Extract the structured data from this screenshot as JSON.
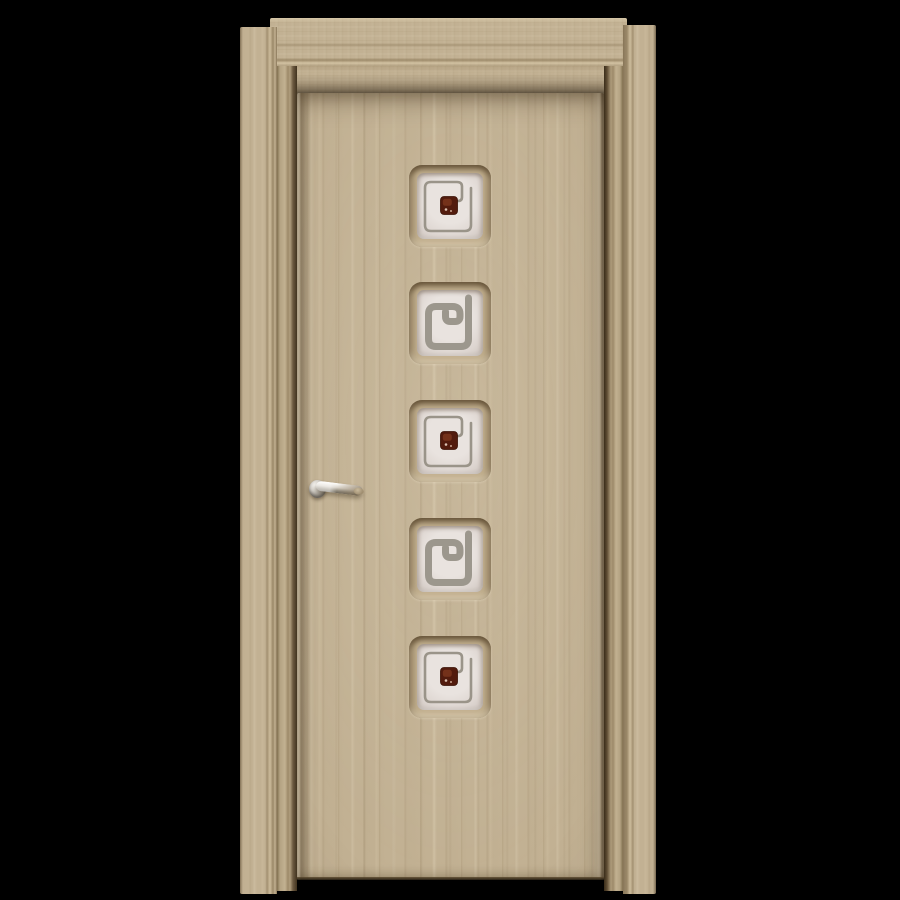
{
  "scene": {
    "type": "product-photo",
    "subject": "closed interior wooden door with frame on black background",
    "background_color": "#000000",
    "colors": {
      "wood": "#c2b193",
      "wood_dark_streak": "#a4916e",
      "wood_light_streak": "#d6c8aa",
      "frame_shadow": "#5e4c33",
      "glass": "#e4dedb",
      "motif_gray": "#9c978d",
      "bead_brown": "#521b0d",
      "handle_chrome": "#d8d2c8"
    },
    "door": {
      "finish": "light oak laminate, vertical grain",
      "frame_finish": "matching light oak casing and jambs",
      "panel_count": 5,
      "panels": [
        {
          "design": "thin-square-spiral-with-brown-bead"
        },
        {
          "design": "thick-square-spiral"
        },
        {
          "design": "thin-square-spiral-with-brown-bead"
        },
        {
          "design": "thick-square-spiral"
        },
        {
          "design": "thin-square-spiral-with-brown-bead"
        }
      ],
      "glass_description": "frosted white square inserts arranged vertically along door centerline",
      "handle": {
        "type": "lever on round rosette",
        "finish": "polished chrome",
        "side": "left",
        "pointing": "right"
      }
    }
  }
}
